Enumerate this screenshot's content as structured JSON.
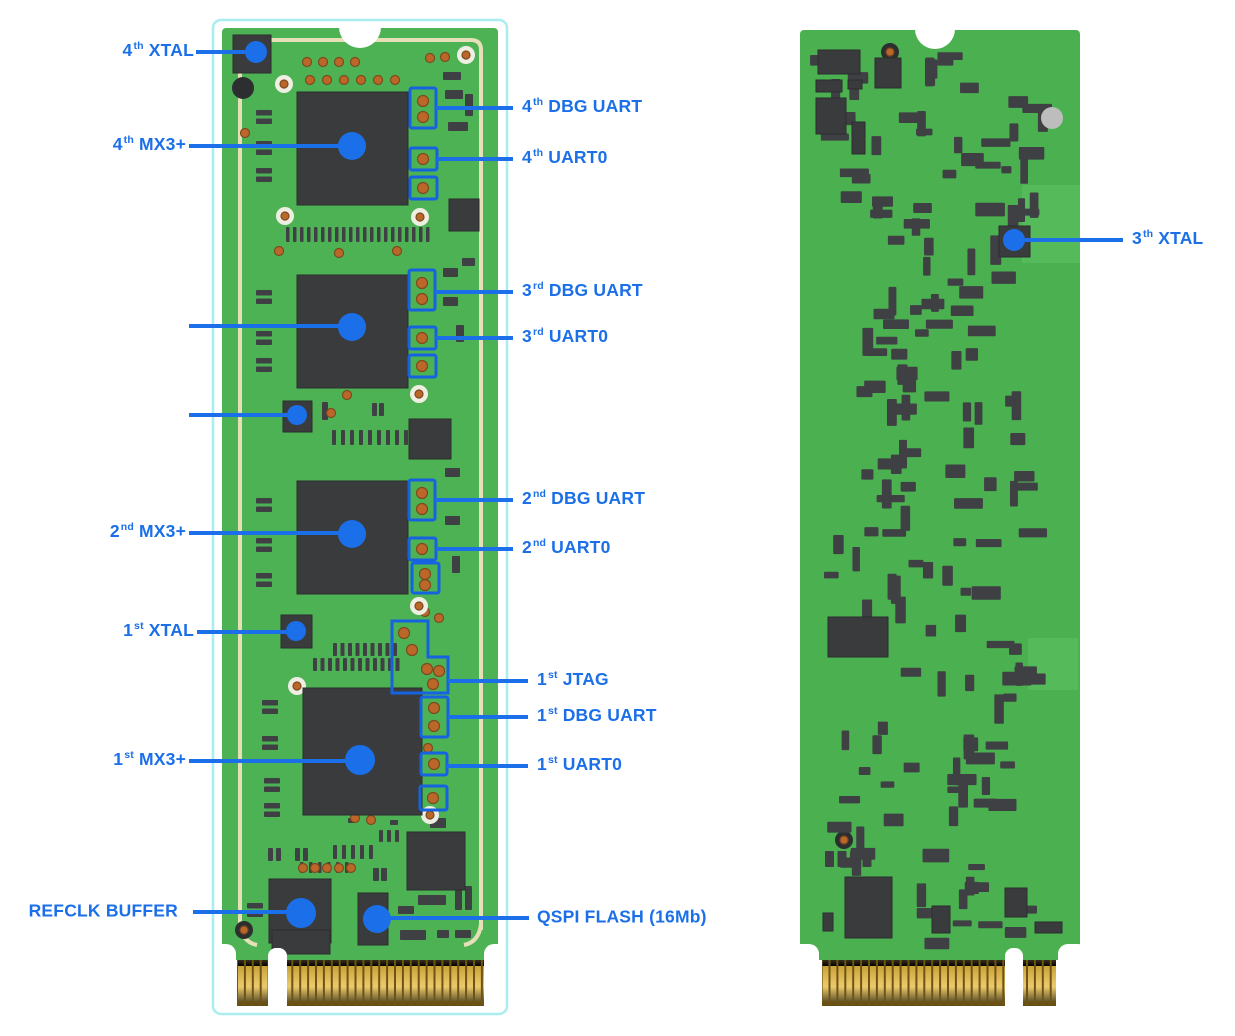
{
  "figure": {
    "type": "annotated-pcb-diagram",
    "boards": [
      "front",
      "back"
    ]
  },
  "colors": {
    "annotation_blue": "#1b6fe8",
    "box_blue": "#1563e0",
    "pcb_front_green": "#4db253",
    "pcb_back_green": "#4bb150",
    "pcb_light_green": "#58bd5c",
    "chip_dark": "#3a3b3d",
    "smd_dark": "#3e4043",
    "silk_cream": "#e6e0b8",
    "outline_cyan": "#a8edf0",
    "gold": "#d2a63e",
    "gold_dark": "#6d5414",
    "pad_orange": "#bc672a",
    "hole_gray": "#bdbdbd",
    "hole_dark": "#2d2e30",
    "pad_white": "#efeee3"
  },
  "callouts": {
    "xtal4": {
      "num": "4",
      "sup": "th",
      "text": "XTAL"
    },
    "mx4": {
      "num": "4",
      "sup": "th",
      "text": "MX3+"
    },
    "dbg4": {
      "num": "4",
      "sup": "th",
      "text": "DBG UART"
    },
    "uart4": {
      "num": "4",
      "sup": "th",
      "text": "UART0"
    },
    "dbg3": {
      "num": "3",
      "sup": "rd",
      "text": "DBG UART"
    },
    "uart3": {
      "num": "3",
      "sup": "rd",
      "text": "UART0"
    },
    "dbg2": {
      "num": "2",
      "sup": "nd",
      "text": "DBG UART"
    },
    "mx2": {
      "num": "2",
      "sup": "nd",
      "text": "MX3+"
    },
    "uart2": {
      "num": "2",
      "sup": "nd",
      "text": "UART0"
    },
    "xtal1": {
      "num": "1",
      "sup": "st",
      "text": "XTAL"
    },
    "jtag1": {
      "num": "1",
      "sup": "st",
      "text": "JTAG"
    },
    "dbg1": {
      "num": "1",
      "sup": "st",
      "text": "DBG UART"
    },
    "uart1": {
      "num": "1",
      "sup": "st",
      "text": "UART0"
    },
    "mx1": {
      "num": "1",
      "sup": "st",
      "text": "MX3+"
    },
    "refclk": {
      "text": "REFCLK BUFFER"
    },
    "qspi": {
      "text": "QSPI FLASH (16Mb)"
    },
    "xtal3": {
      "num": "3",
      "sup": "th",
      "text": "XTAL"
    }
  }
}
